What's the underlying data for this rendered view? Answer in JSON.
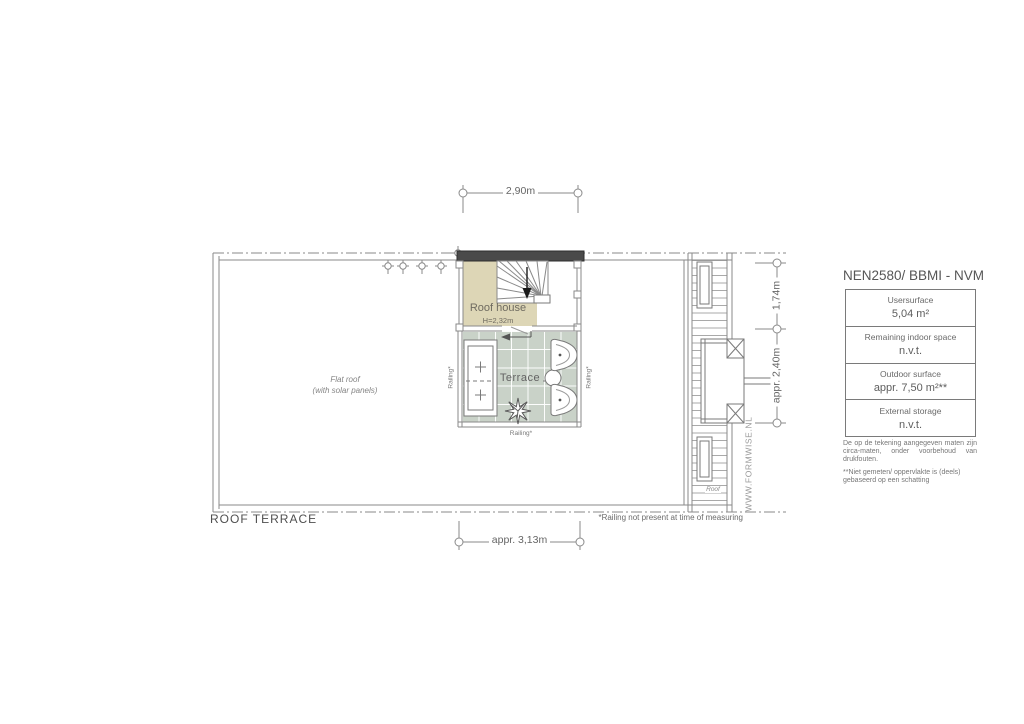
{
  "plan": {
    "title": "ROOF TERRACE",
    "flat_roof": {
      "line1": "Flat roof",
      "line2": "(with solar panels)"
    },
    "roof_house": {
      "label": "Roof house",
      "height": "H=2,32m"
    },
    "terrace_label": "Terrace",
    "roof_strip_label": "Roof",
    "railing_left": "Railing*",
    "railing_right": "Railing*",
    "railing_bottom": "Railing*",
    "dim_top": "2,90m",
    "dim_bottom": "appr. 3,13m",
    "dim_right_upper": "1,74m",
    "dim_right_lower": "appr. 2,40m",
    "footnote": "*Railing not present at time of measuring"
  },
  "legend": {
    "title": "NEN2580/ BBMI - NVM",
    "rows": [
      {
        "label": "Usersurface",
        "value": "5,04 m²"
      },
      {
        "label": "Remaining indoor space",
        "value": "n.v.t."
      },
      {
        "label": "Outdoor surface",
        "value": "appr. 7,50 m²**"
      },
      {
        "label": "External storage",
        "value": "n.v.t."
      }
    ],
    "notes": [
      "De op de tekening aangegeven maten zijn circa-maten, onder voorbehoud van drukfouten.",
      "**Niet gemeten/ oppervlakte is (deels) gebaseerd op een schatting"
    ]
  },
  "watermark": "WWW.FORMWISE.NL",
  "colors": {
    "roof_house_fill": "#ddd6b6",
    "terrace_tile": "#c9d2c8",
    "wall_dark": "#4a4a4a",
    "line_gray": "#8a8a8a",
    "text_gray": "#6e6e6e"
  }
}
